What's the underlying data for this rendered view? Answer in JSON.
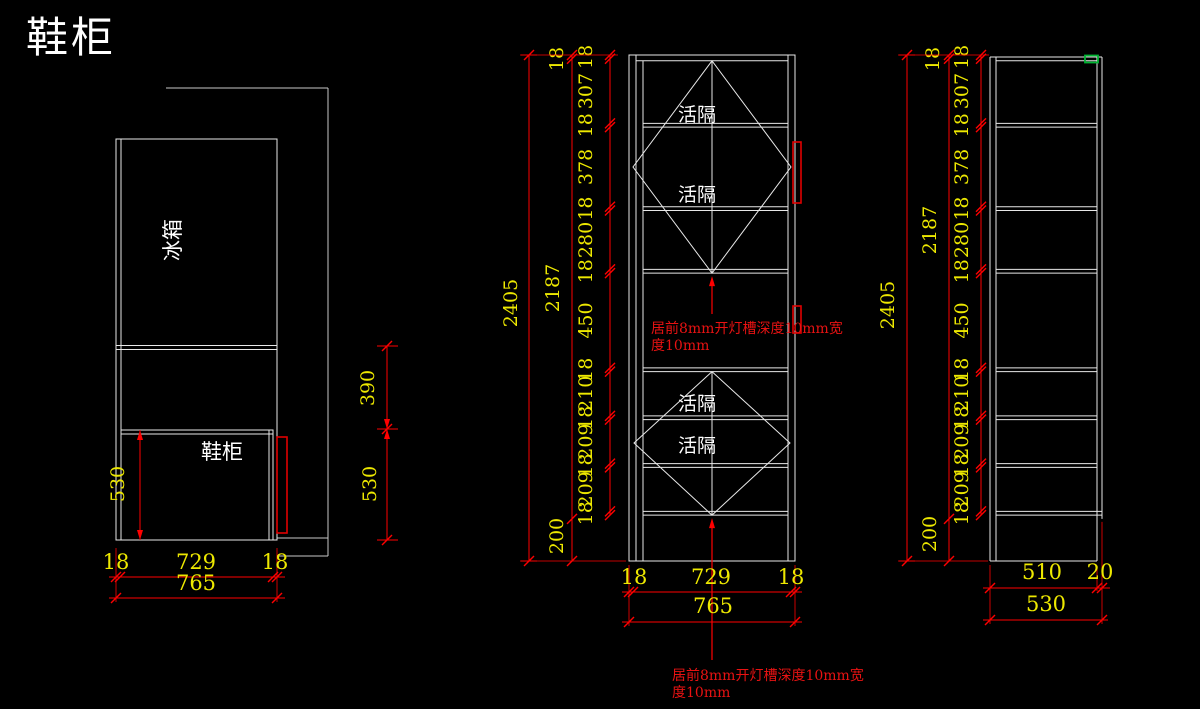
{
  "title": "鞋柜",
  "colors": {
    "background": "#000000",
    "line": "#e8e8e8",
    "wall_line": "#c8c8c8",
    "dimension": "#ff0000",
    "dimension_text": "#ede800",
    "annotation_text": "#e81212",
    "handle": "#e00000",
    "highlight_green": "#00b432"
  },
  "left_view": {
    "fridge_label": "冰箱",
    "shoe_label": "鞋柜",
    "dim_530_left": "530",
    "dim_390": "390",
    "dim_530_right": "530",
    "bottom_dims": [
      "18",
      "729",
      "18"
    ],
    "bottom_total": "765"
  },
  "front_view": {
    "shelf_labels": [
      "活隔",
      "活隔",
      "活隔",
      "活隔"
    ],
    "chain": [
      18,
      307,
      18,
      378,
      18,
      280,
      18,
      450,
      18,
      210,
      18,
      209,
      18,
      209,
      18
    ],
    "top_thickness": "18",
    "inner_total": "2187",
    "plinth": "200",
    "overall": "2405",
    "bottom_dims": [
      "18",
      "729",
      "18"
    ],
    "bottom_total": "765",
    "annotation_mid_line1": "居前8mm开灯槽深度10mm宽",
    "annotation_mid_line2": "度10mm",
    "annotation_bottom_line1": "居前8mm开灯槽深度10mm宽",
    "annotation_bottom_line2": "度10mm"
  },
  "side_view": {
    "chain": [
      18,
      307,
      18,
      378,
      18,
      280,
      18,
      450,
      18,
      210,
      18,
      209,
      18,
      209,
      18
    ],
    "top_thickness": "18",
    "inner_total": "2187",
    "plinth": "200",
    "overall": "2405",
    "bottom_dims": [
      "510",
      "20"
    ],
    "bottom_total": "530"
  }
}
